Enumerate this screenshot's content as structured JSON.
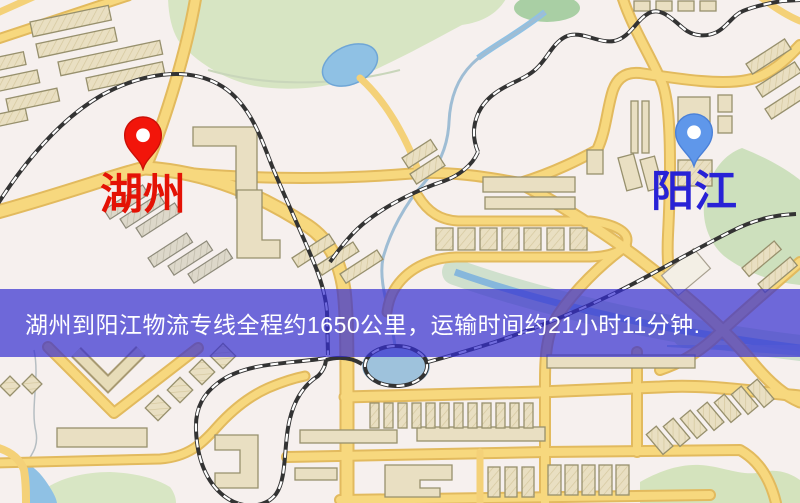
{
  "banner": {
    "text": "湖州到阳江物流专线全程约1650公里，运输时间约21小时11分钟.",
    "bg": "rgba(52,46,208,0.70)",
    "text_color": "#ffffff",
    "top": 289,
    "height": 68
  },
  "markers": [
    {
      "name": "huzhou",
      "label": "湖州",
      "label_color": "#e41205",
      "pin_color": "#f2150a",
      "pin_edge": "#c91007",
      "x": 143,
      "y": 170
    },
    {
      "name": "yangjiang",
      "label": "阳江",
      "label_color": "#2822d6",
      "pin_color": "#5f97ea",
      "pin_edge": "#4a80d8",
      "x": 694,
      "y": 167
    }
  ],
  "map_palette": {
    "background": "#f6f0ee",
    "road_core": "#f7d87e",
    "road_border": "#e2ba5e",
    "building": "#e9dfc2",
    "park_green": "#d7e5c3",
    "water_blue": "#8fc1e4",
    "railway": "#333333"
  }
}
